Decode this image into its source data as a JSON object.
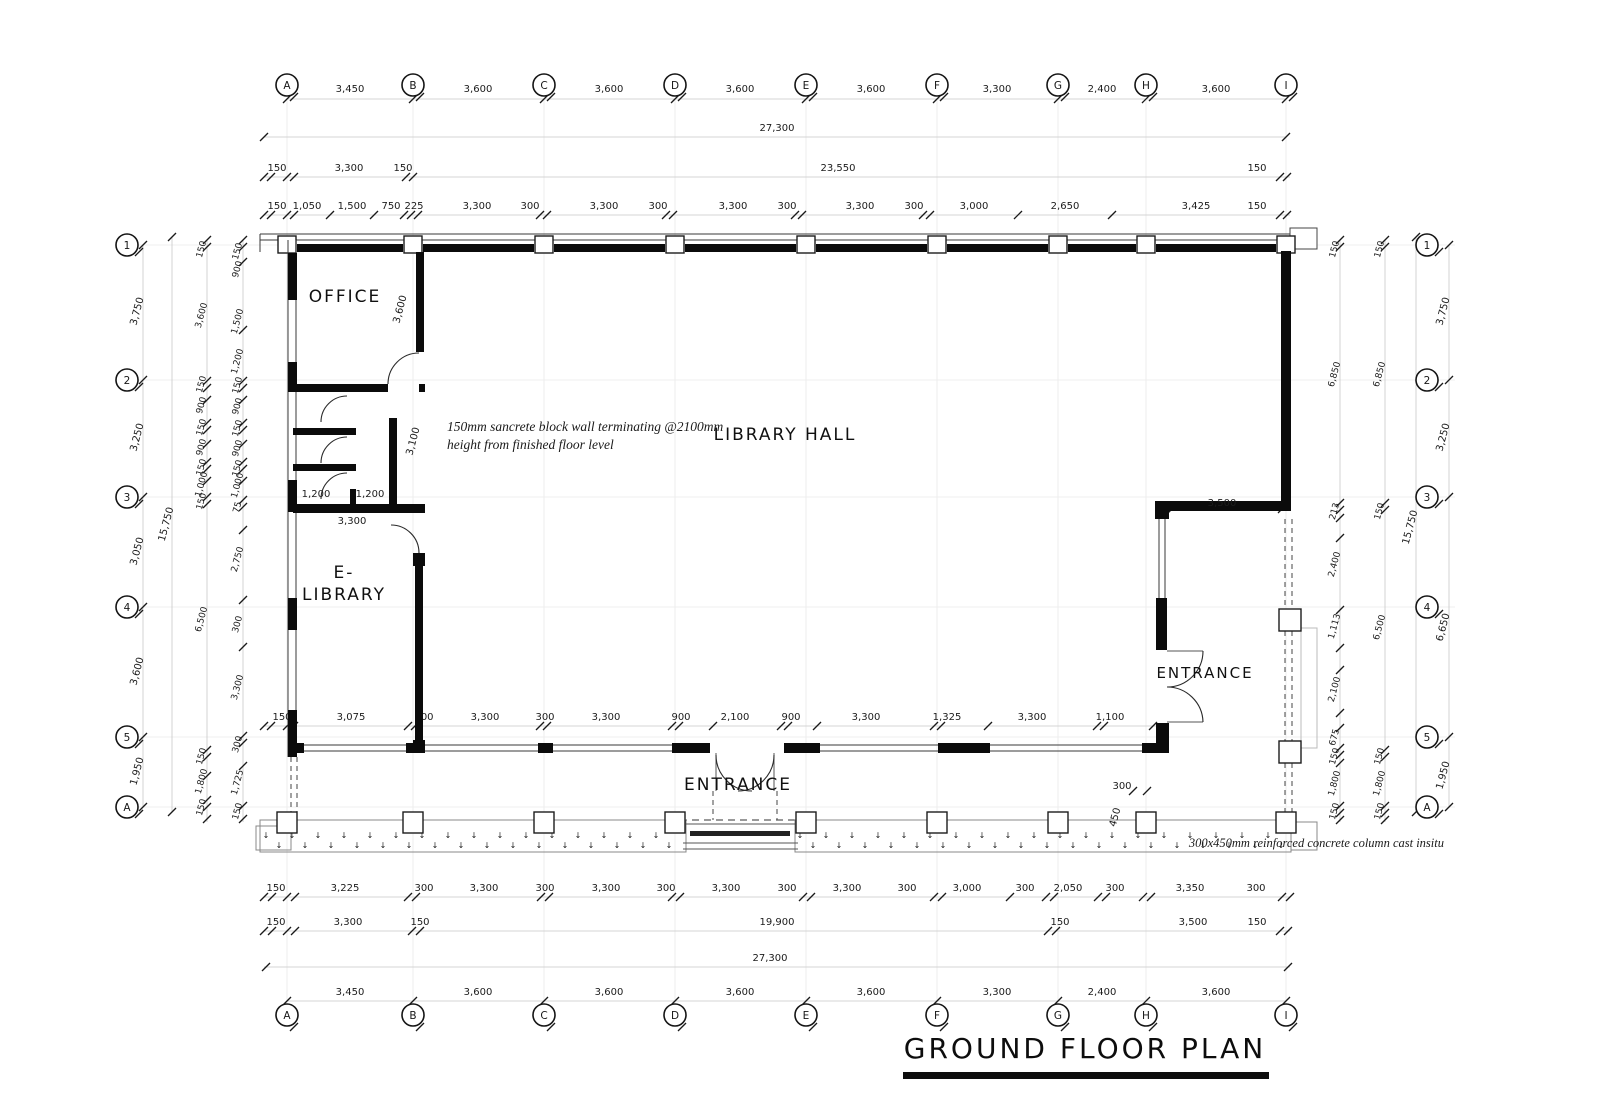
{
  "title": {
    "text": "GROUND FLOOR PLAN"
  },
  "grid": {
    "cols": [
      "A",
      "B",
      "C",
      "D",
      "E",
      "F",
      "G",
      "H",
      "I"
    ],
    "rows": [
      "1",
      "2",
      "3",
      "4",
      "5",
      "A"
    ]
  },
  "rooms": {
    "office": "OFFICE",
    "library_hall": "LIBRARY HALL",
    "e_library_1": "E-",
    "e_library_2": "LIBRARY",
    "entrance_right": "ENTRANCE",
    "entrance_bottom": "ENTRANCE"
  },
  "notes": {
    "wall_1": "150mm sancrete block wall terminating @2100mm",
    "wall_2": "height from finished floor level",
    "column": "300x450mm reinforced concrete column cast insitu"
  },
  "misc": {
    "walkway_glyph": "↓"
  },
  "dims": {
    "top_grid": [
      "3,450",
      "3,600",
      "3,600",
      "3,600",
      "3,600",
      "3,300",
      "2,400",
      "3,600"
    ],
    "top_overall": [
      "27,300"
    ],
    "top_row3": [
      "150",
      "3,300",
      "150",
      "23,550",
      "150"
    ],
    "top_row4": [
      "150",
      "1,050",
      "1,500",
      "750",
      "225",
      "3,300",
      "300",
      "3,300",
      "300",
      "3,300",
      "300",
      "3,300",
      "300",
      "3,000",
      "2,650",
      "3,425",
      "150"
    ],
    "left_outer": [
      "3,750",
      "3,250",
      "3,050",
      "3,600",
      "1,950"
    ],
    "left_overall": [
      "15,750"
    ],
    "left_chain3": [
      "150",
      "3,600",
      "150",
      "900",
      "150",
      "900",
      "150",
      "1,000",
      "150",
      "6,500",
      "150",
      "1,800",
      "150"
    ],
    "left_chain4": [
      "150",
      "900",
      "1,500",
      "1,200",
      "150",
      "900",
      "150",
      "900",
      "150",
      "1,000",
      "75",
      "2,750",
      "300",
      "3,300",
      "300",
      "1,725",
      "150"
    ],
    "right_inner": [
      "150",
      "6,850",
      "213",
      "2,400",
      "1,113",
      "2,100",
      "675",
      "150",
      "1,800",
      "150"
    ],
    "right_mid": [
      "150",
      "6,850",
      "150",
      "6,500",
      "150",
      "1,800",
      "150"
    ],
    "right_overall": [
      "15,750"
    ],
    "right_outer": [
      "3,750",
      "3,250",
      "6,650",
      "1,950"
    ],
    "bottom_inner": [
      "150",
      "3,075",
      "300",
      "3,300",
      "300",
      "3,300",
      "900",
      "2,100",
      "900",
      "3,300",
      "1,325",
      "3,300",
      "1,100"
    ],
    "bottom_row2": [
      "150",
      "3,225",
      "300",
      "3,300",
      "300",
      "3,300",
      "300",
      "3,300",
      "300",
      "3,300",
      "300",
      "3,000",
      "300",
      "2,050",
      "300",
      "3,350",
      "300"
    ],
    "bottom_row3": [
      "150",
      "3,300",
      "150",
      "19,900",
      "150",
      "3,500",
      "150"
    ],
    "bottom_overall": [
      "27,300"
    ],
    "bottom_grid": [
      "3,450",
      "3,600",
      "3,600",
      "3,600",
      "3,600",
      "3,300",
      "2,400",
      "3,600"
    ],
    "interior": {
      "office_depth": "3,600",
      "toilet_depth": "3,100",
      "wc_1": "1,200",
      "wc_2": "1,200",
      "toilet_width": "3,300",
      "entry_wall": "3,500",
      "col_w": "300",
      "col_d": "450"
    }
  }
}
